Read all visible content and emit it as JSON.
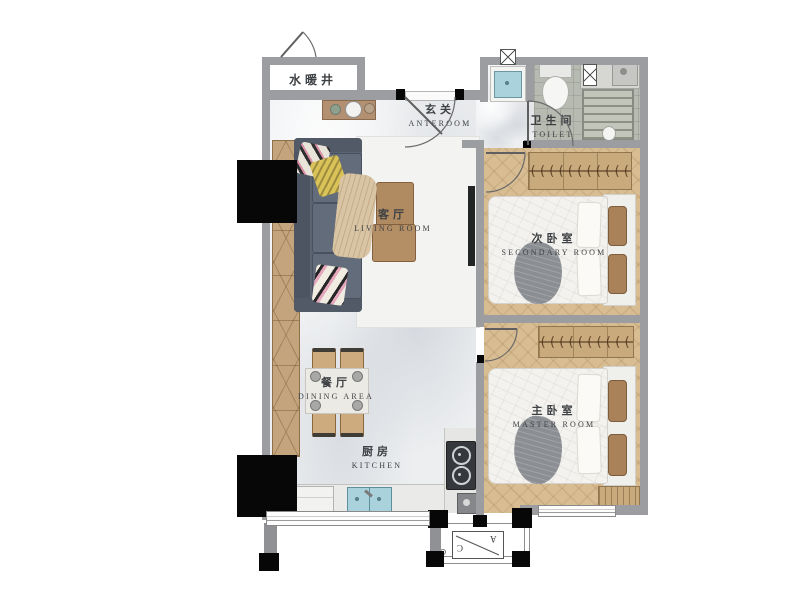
{
  "rooms": {
    "utility_shaft": {
      "zh": "水暖井"
    },
    "anteroom": {
      "zh": "玄关",
      "en": "ANTEROOM"
    },
    "toilet": {
      "zh": "卫生间",
      "en": "TOILET"
    },
    "living_room": {
      "zh": "客厅",
      "en": "LIVING ROOM"
    },
    "secondary_room": {
      "zh": "次卧室",
      "en": "SECONDARY ROOM"
    },
    "master_room": {
      "zh": "主卧室",
      "en": "MASTER ROOM"
    },
    "dining_area": {
      "zh": "餐厅",
      "en": "DINING AREA"
    },
    "kitchen": {
      "zh": "厨房",
      "en": "KITCHEN"
    }
  },
  "ac_platform": {
    "letter_a": "A",
    "letter_c": "C"
  },
  "decor": {
    "wardrobe_hangers": "(((((((((((((("
  },
  "colors": {
    "wall": "#9b9da0",
    "structural_black": "#070707",
    "marble_floor": "#eceef0",
    "wood_floor": "#d8bc92",
    "bath_tile": "#b7bab0",
    "sofa": "#5b6472",
    "sink_blue": "#a9d2dd",
    "wardrobe_wood": "#c9aa7c",
    "bed_white": "#f3f2ef",
    "blanket_gray": "#8b8e92",
    "label_text": "#3e4144"
  }
}
